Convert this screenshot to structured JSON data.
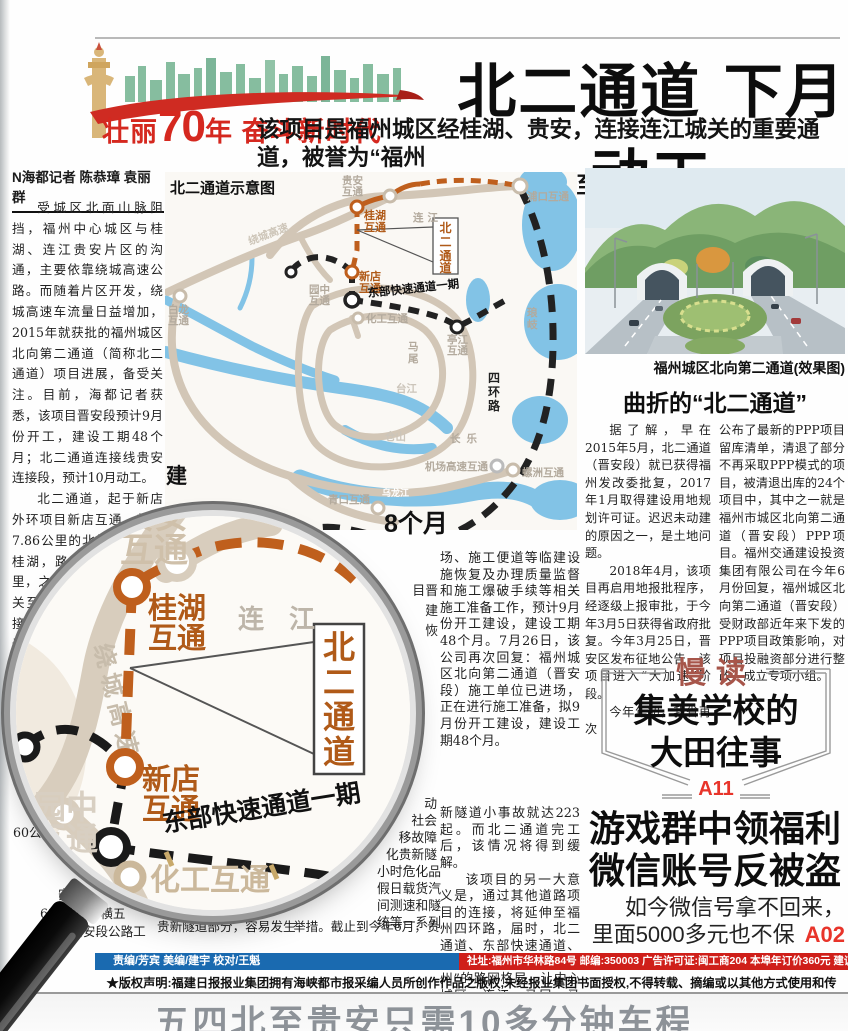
{
  "banner": {
    "slogan_left": "壮丽",
    "slogan_num": "70",
    "slogan_year": "年",
    "slogan_right": " 奋斗新时代"
  },
  "headline": {
    "title": "北二通道 下月动工",
    "sub_line1": "该项目是福州城区经桂湖、贵安，连接连江城关的重要通道，被誉为“福州",
    "sub_line2": "北大动脉”；工期4年，通车后五四北至贵安只需10多分钟车程"
  },
  "byline": "N海都记者 陈恭璋 袁丽群",
  "article_left": {
    "p1": "受城区北面山脉阻挡，福州中心城区与桂湖、连江贵安片区的沟通，主要依靠绕城高速公路。而随着片区开发，绕城高速车流量日益增加，2015年就获批的福州城区北向第二通道（简称北二通道）项目进展，备受关注。目前，海都记者获悉，该项目晋安段预计9月份开工，建设工期48个月；北二通道连接线贵安连接段，预计10月动工。",
    "p2": "北二通道，起于新店外环项目新店互通，新建7.86公里的北岭隧道接至桂湖，路线长约13.63公里，之后与“横五线连江城关至贵安段公路工程”相接，连接连江城关。线路设计时速为60公里，通车后，五四北至贵安只需10多分钟车程",
    "frag1": "60公",
    "frag2": "安后，",
    "frag3": "63公里的“横五",
    "frag4": "关至贵安段公路工"
  },
  "map": {
    "title": "北二通道示意图",
    "guian": [
      "贵安",
      "互通"
    ],
    "pukou": "浦口互通",
    "guihu": [
      "桂湖",
      "互通"
    ],
    "xindian": [
      "新店",
      "互通"
    ],
    "yuanzhong": [
      "园中",
      "互通"
    ],
    "huagong": "化工互通",
    "bailong": [
      "白龙",
      "互通"
    ],
    "tingjiang": [
      "亭江",
      "互通"
    ],
    "luozhou": "螺洲互通",
    "qingkou": "青口互通",
    "jichang": "机场高速互通",
    "dongbu": "东部快速通道一期",
    "lianjiang": "连江",
    "mawei": [
      "马",
      "尾"
    ],
    "changle": "长乐",
    "langqi": [
      "琅",
      "岐"
    ],
    "sihuan": [
      "四",
      "环",
      "路"
    ],
    "raocheng": "绕城高速",
    "taijiang": "台江",
    "cangshan": "仓山",
    "wulongjiang": "乌龙江",
    "beier": [
      "北",
      "二",
      "通",
      "道"
    ]
  },
  "photo": {
    "caption": "福州城区北向第二通道(效果图)"
  },
  "article_right": {
    "title": "曲折的“北二通道”",
    "col1_p1": "据了解，早在2015年5月，北二通道（晋安段）就已获得福州发改委批复，2017年1月取得建设用地规划许可证。迟迟未动建的原因之一，是土地问题。",
    "col1_p2": "2018年4月，该项目再启用地报批程序，经逐级上报审批，于今年3月5日获得省政府批复。今年3月25日，晋安区发布征地公告，该项目进入“大加速”阶段。",
    "col1_p3": "今年年初，我省再次",
    "col2_p1": "公布了最新的PPP项目留库清单，清退了部分不再采取PPP模式的项目，被清退出库的24个项目中，其中之一就是福州市城区北向第二通道（晋安段）PPP项目。福州交通建设投资集团有限公司在今年6月份回复，福州城区北向第二通道（晋安段）受财政部近年来下发的PPP项目政策影响，对项目投融资部分进行整改，成立专项小组。"
  },
  "mid": {
    "jian": "建",
    "headline_frag": "8个月",
    "col4_p1": "场、施工便道等临建设施恢复及办理质量监督和施工爆破手续等相关施工准备工作，预计9月份开工建设，建设工期48个月。7月26日，该公司再次回复：福州城区北向第二通道（晋安段）施工单位已进场，正在进行施工准备，拟9月份开工建设，建设工期48个月。",
    "col4_p2a": "新隧道小事故就达223起。而北二通道完工后，该情况将得到缓解。",
    "col4_p2b": "该项目的另一大意义是，通过其他道路项目的连接，将延伸至福州四环路，届时，北二通道、东部快速通道、四环路将形成“大福州”的路网格局，让中心城区、连江、马尾、马尾琅岐沟通更为便捷。",
    "col3_top_frags": [
      "目晋",
      "建",
      "恢"
    ],
    "col3_frags": [
      "动",
      "社会",
      "移故障",
      "化贵新隧",
      "小时危化品",
      "假日载货汽",
      "间测速和隧",
      "统等一系列"
    ],
    "col3_last": "举措。截止到今年6月，贵",
    "col2_last": "贵新隧道部分，容易发生"
  },
  "manread": {
    "tag": "慢读",
    "title_line1": "集美学校的",
    "title_line2": "大田往事",
    "page": "A11"
  },
  "promo": {
    "line1": "游戏群中领福利",
    "line2": "微信账号反被盗",
    "sub1": "如今微信号拿不回来，",
    "sub2": "里面5000多元也不保",
    "page": "A02"
  },
  "magnifier": {
    "guian": [
      "贵安",
      "互通"
    ],
    "guihu": [
      "桂湖",
      "互通"
    ],
    "xindian": [
      "新店",
      "互通"
    ],
    "yuanzhong": [
      "园中",
      "互通"
    ],
    "huagong": "化工互通",
    "lianjiang": "连 江",
    "raocheng": "绕城高速",
    "dongbu": "东部快速通道一期",
    "beier": [
      "北",
      "二",
      "通",
      "道"
    ]
  },
  "footer": {
    "blue": "责编/芳宾  美编/建宇  校对/王魁",
    "red": "社址:福州市华林路84号  邮编:350003  广告许可证:闽工商204  本埠年订价360元  建议零售价1元",
    "copyright": "★版权声明:福建日报报业集团拥有海峡都市报采编人员所创作作品之版权,未经报业集团书面授权,不得转载、摘编或以其他方式使用和传播。★"
  },
  "bottom": {
    "text": "五四北至贵安只需10多分钟车程"
  },
  "colors": {
    "accent_red": "#d5281f",
    "orange_route": "#bf5f1d",
    "blue_bar": "#1a6ab0",
    "red_bar": "#cf1f1a",
    "page_red": "#e8342a",
    "water": "#82c3e6",
    "road_tan": "#d2c6b6"
  }
}
